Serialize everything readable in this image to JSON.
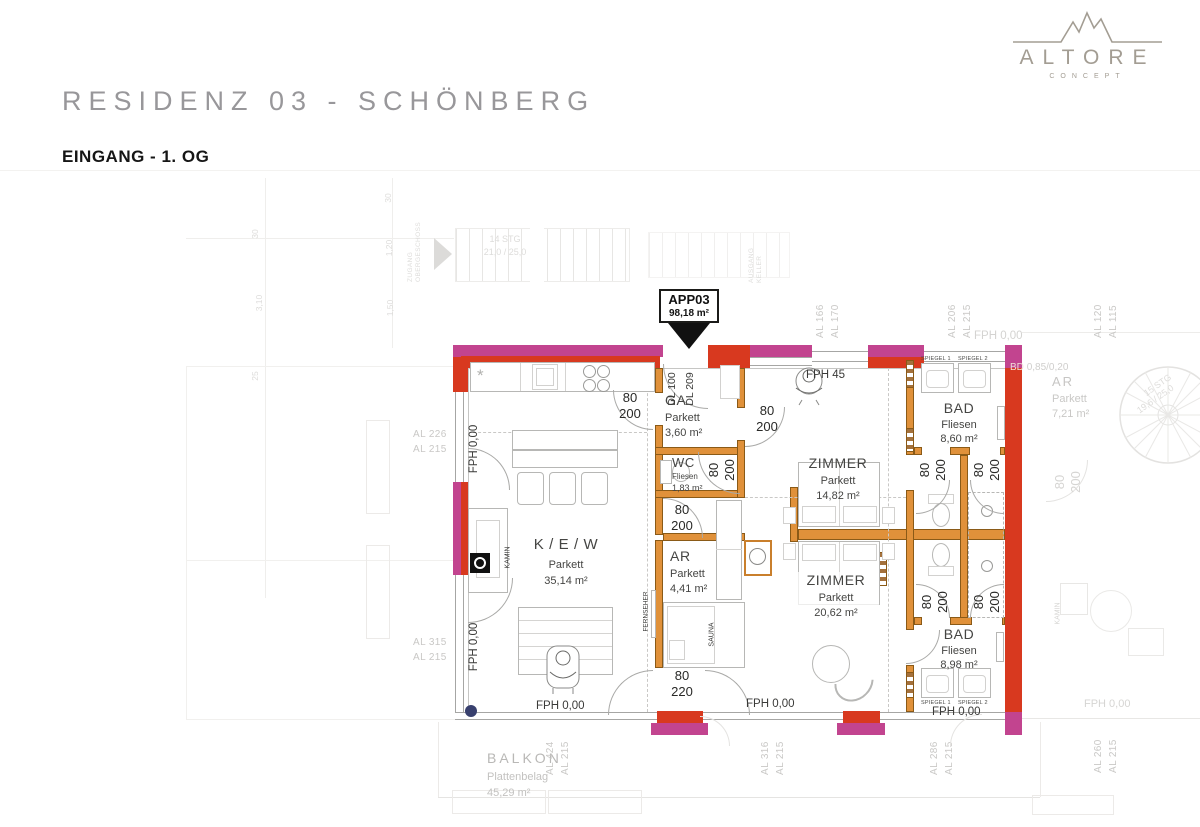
{
  "header": {
    "title": "RESIDENZ 03 - SCHÖNBERG",
    "subtitle": "EINGANG - 1. OG"
  },
  "logo": {
    "brand": "ALTORE",
    "sub": "CONCEPT"
  },
  "apartment": {
    "id": "APP03",
    "area": "98,18 m²"
  },
  "entrance": {
    "dl1": "DL 100",
    "dl2": "DL 209"
  },
  "rooms": {
    "kew": {
      "name": "K / E / W",
      "floor": "Parkett",
      "area": "35,14 m²"
    },
    "ga": {
      "name": "GA",
      "floor": "Parkett",
      "area": "3,60 m²"
    },
    "wc": {
      "name": "WC",
      "floor": "Fliesen",
      "area": "1,83 m²"
    },
    "ar": {
      "name": "AR",
      "floor": "Parkett",
      "area": "4,41 m²"
    },
    "zimmer1": {
      "name": "ZIMMER",
      "floor": "Parkett",
      "area": "14,82 m²"
    },
    "zimmer2": {
      "name": "ZIMMER",
      "floor": "Parkett",
      "area": "20,62 m²"
    },
    "bad1": {
      "name": "BAD",
      "floor": "Fliesen",
      "area": "8,60 m²"
    },
    "bad2": {
      "name": "BAD",
      "floor": "Fliesen",
      "area": "8,98 m²"
    },
    "balkon": {
      "name": "BALKON",
      "floor": "Plattenbelag",
      "area": "45,29 m²"
    }
  },
  "neighbor": {
    "ar": {
      "name": "AR",
      "floor": "Parkett",
      "area": "7,21 m²"
    },
    "kamin": "KAMIN",
    "fph": "FPH 0,00"
  },
  "door_dims": [
    {
      "w": "80",
      "h": "200"
    },
    {
      "w": "80",
      "h": "200"
    },
    {
      "w": "80",
      "h": "200"
    },
    {
      "w": "80",
      "h": "200"
    },
    {
      "w": "80",
      "h": "220"
    },
    {
      "w": "80",
      "h": "200"
    },
    {
      "w": "80",
      "h": "200"
    },
    {
      "w": "80",
      "h": "200"
    },
    {
      "w": "80",
      "h": "200"
    },
    {
      "w": "80",
      "h": "200"
    }
  ],
  "labels": {
    "fph000": "FPH 0,00",
    "fph45": "FPH 45",
    "kamin": "KAMIN",
    "sauna": "SAUNA",
    "fernseher": "FERNSEHER",
    "wmtr": "WM/TR",
    "spiegel1": "SPIEGEL 1",
    "spiegel2": "SPIEGEL 2",
    "bd1": "BD",
    "bd2": "0,85/0,20"
  },
  "wall_tags": {
    "left_top": [
      "AL 226",
      "AL 215"
    ],
    "left_bottom": [
      "AL 315",
      "AL 215"
    ],
    "top1": [
      "AL 166",
      "AL 170"
    ],
    "top2": [
      "AL 206",
      "AL 215"
    ],
    "top3": [
      "AL 120",
      "AL 115"
    ],
    "bottom1": [
      "AL 424",
      "AL 215"
    ],
    "bottom2": [
      "AL 316",
      "AL 215"
    ],
    "bottom3": [
      "AL 286",
      "AL 215"
    ],
    "bottom4": [
      "AL 260",
      "AL 215"
    ]
  },
  "background": {
    "stairs1a": "14 STG",
    "stairs1b": "21,0 / 25,0",
    "stairs2a": "15 STG",
    "stairs2b": "19,6 / 25,0",
    "zugang1": "ZUGANG",
    "zugang2": "OBERGESCHOSS",
    "ausgang1": "AUSGANG",
    "ausgang2": "KELLER",
    "dims": [
      "30",
      "3,10",
      "25",
      "30",
      "1,20",
      "1,50"
    ]
  },
  "colors": {
    "wall_red": "#d8391f",
    "wall_magenta": "#c2448f",
    "wall_orange": "#e0913a",
    "marker_blue": "#38406e"
  }
}
